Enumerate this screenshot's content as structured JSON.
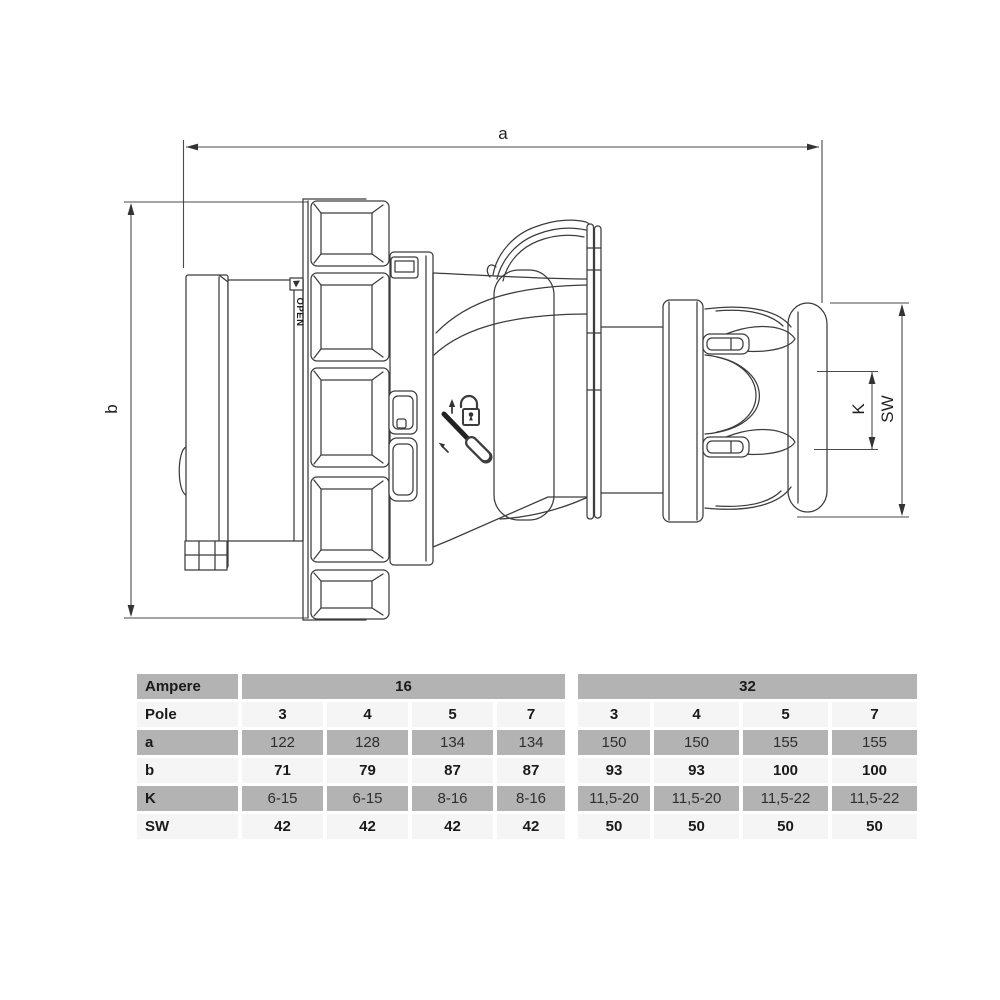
{
  "drawing": {
    "dimension_labels": {
      "a": "a",
      "b": "b",
      "K": "K",
      "SW": "SW"
    },
    "molded_text": "OPEN",
    "line_color": "#3c3c3c",
    "dimension_color": "#4a4a4a"
  },
  "table": {
    "corner_label": "Ampere",
    "groups": [
      {
        "label": "16",
        "span": 4
      },
      {
        "label": "32",
        "span": 4
      }
    ],
    "rows": [
      {
        "label": "Pole",
        "values": [
          "3",
          "4",
          "5",
          "7",
          "3",
          "4",
          "5",
          "7"
        ]
      },
      {
        "label": "a",
        "values": [
          "122",
          "128",
          "134",
          "134",
          "150",
          "150",
          "155",
          "155"
        ]
      },
      {
        "label": "b",
        "values": [
          "71",
          "79",
          "87",
          "87",
          "93",
          "93",
          "100",
          "100"
        ]
      },
      {
        "label": "K",
        "values": [
          "6-15",
          "6-15",
          "8-16",
          "8-16",
          "11,5-20",
          "11,5-20",
          "11,5-22",
          "11,5-22"
        ]
      },
      {
        "label": "SW",
        "values": [
          "42",
          "42",
          "42",
          "42",
          "50",
          "50",
          "50",
          "50"
        ]
      }
    ],
    "colors": {
      "shaded_row": "#b3b3b3",
      "light_row": "#f5f5f5"
    }
  }
}
